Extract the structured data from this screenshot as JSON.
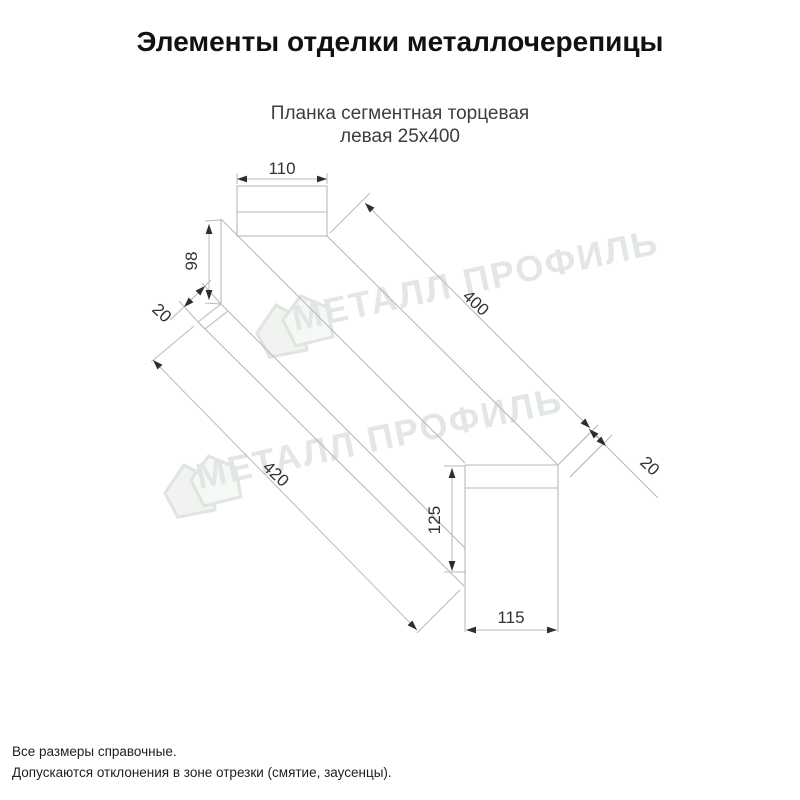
{
  "header": {
    "title": "Элементы отделки металлочерепицы"
  },
  "product": {
    "name_line1": "Планка сегментная торцевая",
    "name_line2": "левая 25х400"
  },
  "drawing": {
    "type": "isometric technical drawing of left segmental end strip",
    "dimensions": {
      "top_width": "110",
      "left_height": "98",
      "left_fold": "20",
      "length_top": "400",
      "right_fold": "20",
      "length_bottom": "420",
      "right_height": "125",
      "bottom_width": "115"
    },
    "watermark": {
      "text": "МЕТАЛЛ ПРОФИЛЬ"
    }
  },
  "footer": {
    "note1": "Все размеры справочные.",
    "note2": "Допускаются отклонения в зоне отрезки (смятие, заусенцы)."
  },
  "colors": {
    "line": "#b7babd",
    "arrow": "#2e2e2e",
    "dim_text": "#323232",
    "watermark": "#e3e7e3",
    "subtitle": "#3b3d40"
  }
}
